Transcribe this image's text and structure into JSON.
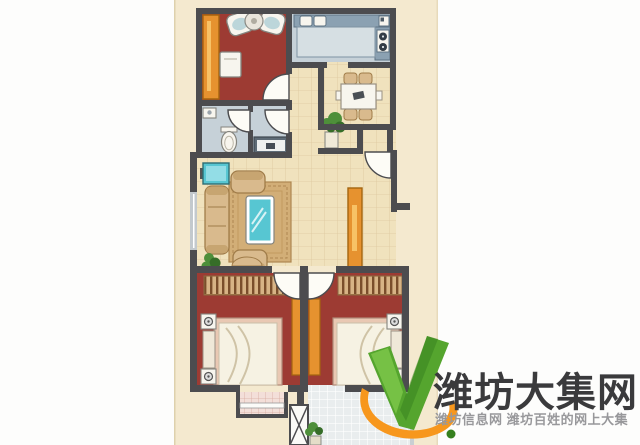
{
  "watermark": {
    "brand": "潍坊大集网",
    "tagline": "潍坊信息网 潍坊百姓的网上大集",
    "logo_shapes": [
      "green-check",
      "orange-swoosh",
      "green-leaf-dot"
    ]
  },
  "floorplan": {
    "rooms": [
      "study",
      "kitchen",
      "dining-nook",
      "bathroom",
      "hallway",
      "entry",
      "living-room",
      "bedroom-left",
      "bedroom-right",
      "bay-window",
      "balcony"
    ],
    "furniture_icons": [
      "wardrobe",
      "desk",
      "lounge-chairs",
      "round-table",
      "kitchen-counter",
      "double-sink",
      "stove",
      "fridge",
      "dining-table",
      "dining-chairs",
      "potted-plant",
      "tv",
      "sofa",
      "armchair",
      "rug",
      "coffee-table",
      "shoe-cabinet",
      "toilet",
      "wash-basin",
      "vanity",
      "closet",
      "bed",
      "nightstand-lamp",
      "x-column",
      "floor-tiles"
    ]
  },
  "palette": {
    "page_bg": "#fdfdfc",
    "paper": "#f4e9cf",
    "paper_edge": "#ded1ad",
    "wall": "#4c4c4f",
    "cream": "#f0e2bd",
    "cream_line": "#cdb184",
    "red": "#9d3b33",
    "wet": "#c6d1d8",
    "counter": "#8ba1b2",
    "counter_edge": "#5f7484",
    "counter_top": "#d6dfe3",
    "orange": "#e6922f",
    "orange_light": "#f7c266",
    "orange_edge": "#a4650f",
    "tan": "#d9ba8d",
    "tan_dark": "#a07c49",
    "rug": "#d2ae77",
    "rug_line": "#ae8750",
    "teal": "#57c6d2",
    "teal_dark": "#2d6d74",
    "teal_light": "#93dde6",
    "fixture_white": "#f7f5ee",
    "fixture_edge": "#84847e",
    "bed_frame": "#e9c8b3",
    "bed_sheet": "#f6f2e3",
    "bed_fold": "#cfc3a6",
    "stripe_bg": "#d7b385",
    "stripe_line": "#7a4e2b",
    "balcony": "#e9edee",
    "balcony_line": "#ffffff",
    "bay": "#f3dfd9",
    "bay_line": "#d8aba0",
    "window_glass": "#c3c9cd",
    "plant": "#4e8f3a",
    "plant_dark": "#366d28",
    "door_leaf": "#fdfcf6",
    "logo_green": "#55a52e",
    "logo_green_light": "#7cc649",
    "logo_green_dark": "#35801e",
    "logo_orange": "#f7971d",
    "brand": "#3a3a3c",
    "tagline": "#98989b"
  }
}
